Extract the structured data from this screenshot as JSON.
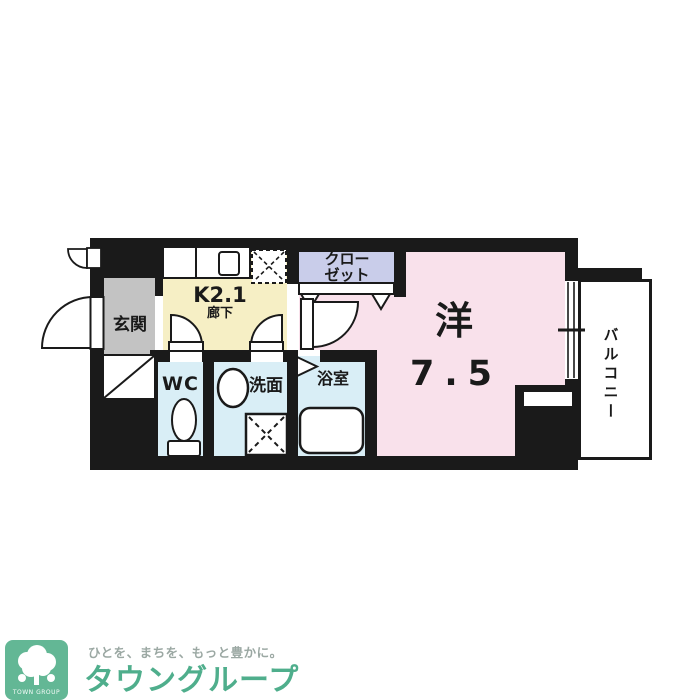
{
  "floorplan": {
    "rooms": {
      "genkan": {
        "label": "玄関"
      },
      "kitchen": {
        "label": "K2.1",
        "sublabel": "廊下"
      },
      "wc": {
        "label": "WC"
      },
      "washroom": {
        "label": "洗面"
      },
      "bathroom": {
        "label": "浴室"
      },
      "closet": {
        "label": "クローゼット"
      },
      "western_room": {
        "label": "洋",
        "size": "7.5"
      },
      "balcony": {
        "label": "バルコニー"
      }
    }
  },
  "colors": {
    "wall": "#1A1A1A",
    "western_room": "#F9E1EB",
    "kitchen": "#F6EFC5",
    "wet_rooms": "#D9EEF6",
    "closet": "#C9CDEA",
    "genkan": "#C3C3C3",
    "logo_bg": "#63B795",
    "brand": "#4FAE8C",
    "tagline": "#9BA8A3"
  },
  "footer": {
    "logo_square_text": "TOWN GROUP",
    "tagline": "ひとを、まちを、もっと豊かに。",
    "brand": "タウングループ"
  }
}
